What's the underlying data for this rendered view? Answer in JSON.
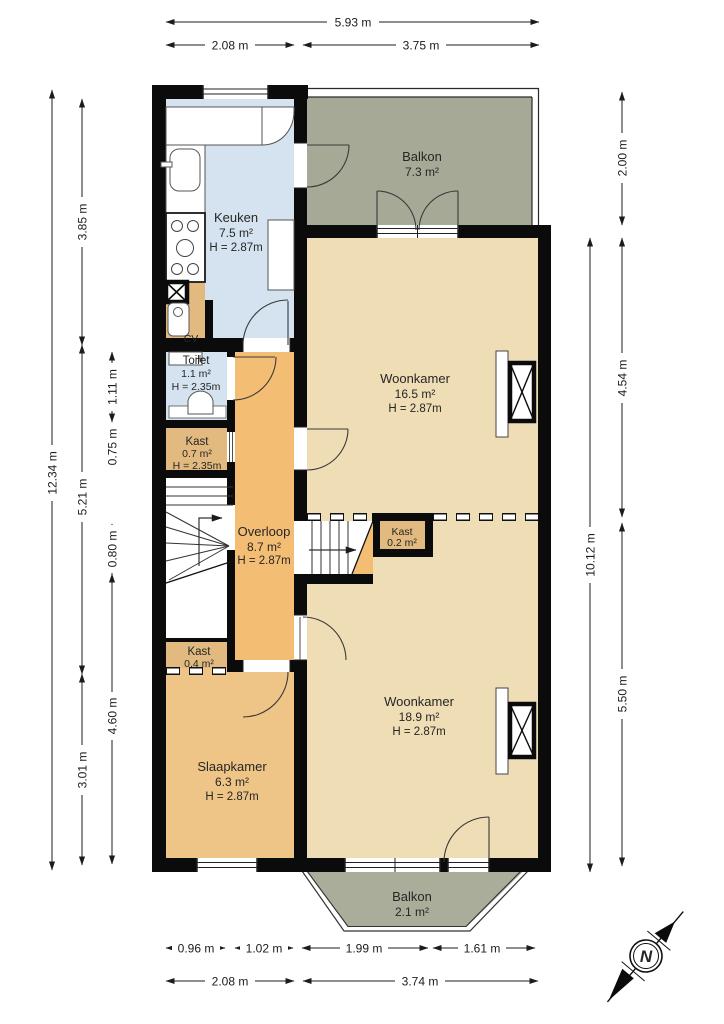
{
  "rooms": {
    "balkon_boven": {
      "name": "Balkon",
      "area": "7.3 m²"
    },
    "keuken": {
      "name": "Keuken",
      "area": "7.5 m²",
      "height": "H = 2.87m"
    },
    "toilet": {
      "name": "Toilet",
      "area": "1.1 m²",
      "height": "H = 2.35m"
    },
    "kast_07": {
      "name": "Kast",
      "area": "0.7 m²",
      "height": "H = 2.35m"
    },
    "woonkamer_voor": {
      "name": "Woonkamer",
      "area": "16.5 m²",
      "height": "H = 2.87m"
    },
    "overloop": {
      "name": "Overloop",
      "area": "8.7 m²",
      "height": "H = 2.87m"
    },
    "kast_02": {
      "name": "Kast",
      "area": "0.2 m²"
    },
    "kast_04": {
      "name": "Kast",
      "area": "0.4 m²"
    },
    "woonkamer_achter": {
      "name": "Woonkamer",
      "area": "18.9 m²",
      "height": "H = 2.87m"
    },
    "slaapkamer": {
      "name": "Slaapkamer",
      "area": "6.3 m²",
      "height": "H = 2.87m"
    },
    "balkon_onder": {
      "name": "Balkon",
      "area": "2.1 m²"
    },
    "cv": {
      "label": "CV"
    }
  },
  "dimensions": {
    "top": {
      "total": "5.93 m",
      "segments": [
        "2.08 m",
        "3.75 m"
      ]
    },
    "bottom": {
      "segments_inner": [
        "0.96 m",
        "1.02 m",
        "1.99 m",
        "1.61 m"
      ],
      "segments_outer": [
        "2.08 m",
        "3.74 m"
      ]
    },
    "left": {
      "total": "12.34 m",
      "middle": [
        "3.85 m",
        "5.21 m",
        "3.01 m"
      ],
      "inner": [
        "1.11 m",
        "0.75 m",
        "0.80 m",
        "4.60 m"
      ]
    },
    "right": {
      "total": "10.12 m",
      "inner": [
        "2.00 m",
        "4.54 m",
        "5.50 m"
      ]
    }
  },
  "compass": {
    "north_label": "N"
  },
  "colors": {
    "wall": "#0b0b0b",
    "kitchen_blue": "#d4e3ef",
    "balcony_green": "#a6a996",
    "bay_green": "#a9ad9a",
    "living_tan": "#efddb6",
    "landing_orange": "#f3bd74",
    "bedroom_orange": "#eec487",
    "closet_tan": "#e2ba80"
  }
}
